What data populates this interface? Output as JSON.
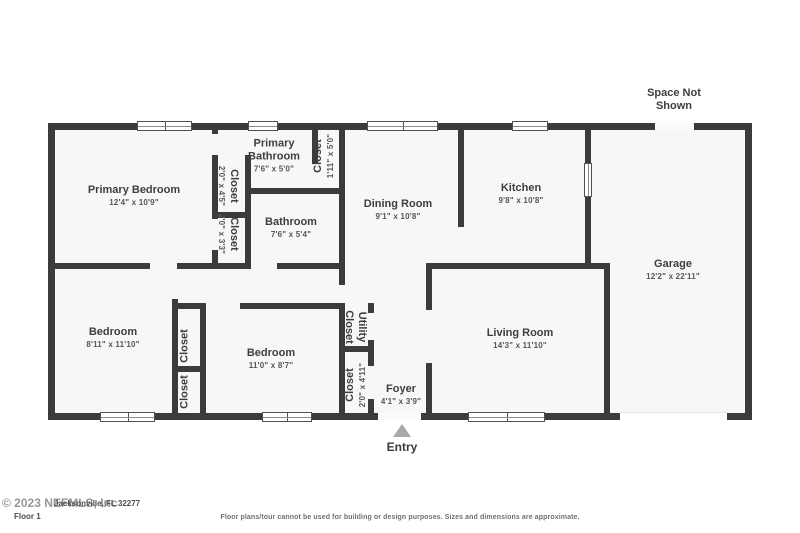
{
  "plan": {
    "space_not_shown": "Space Not Shown",
    "entry": "Entry",
    "rooms": [
      {
        "name": "Primary Bedroom",
        "dims": "12'4\" x 10'9\""
      },
      {
        "name": "Primary Bathroom",
        "dims": "7'6\" x 5'0\""
      },
      {
        "name": "Closet",
        "dims": "1'11\" x 5'0\""
      },
      {
        "name": "Closet",
        "dims": "2'0\" x 4'5\""
      },
      {
        "name": "Closet",
        "dims": "2'0\" x 3'3\""
      },
      {
        "name": "Bathroom",
        "dims": "7'6\" x 5'4\""
      },
      {
        "name": "Dining Room",
        "dims": "9'1\" x 10'8\""
      },
      {
        "name": "Kitchen",
        "dims": "9'8\" x 10'8\""
      },
      {
        "name": "Garage",
        "dims": "12'2\" x 22'11\""
      },
      {
        "name": "Bedroom",
        "dims": "8'11\" x 11'10\""
      },
      {
        "name": "Closet",
        "dims": ""
      },
      {
        "name": "Closet",
        "dims": ""
      },
      {
        "name": "Bedroom",
        "dims": "11'0\" x 8'7\""
      },
      {
        "name": "Utility Closet",
        "dims": ""
      },
      {
        "name": "Closet",
        "dims": "2'0\" x 4'11\""
      },
      {
        "name": "Foyer",
        "dims": "4'1\" x 3'9\""
      },
      {
        "name": "Living Room",
        "dims": "14'3\" x 11'10\""
      }
    ]
  },
  "footer": {
    "watermark": "© 2023 NEFMLS, Inc",
    "address": "Jacksonville, FL 32277",
    "floor_label": "Floor 1",
    "disclaimer": "Floor plans/tour cannot be used for building or design purposes. Sizes and dimensions are approximate."
  },
  "colors": {
    "wall": "#3b3b3b",
    "floor": "#f7f7f8",
    "entry_triangle": "#a9a9ad"
  }
}
